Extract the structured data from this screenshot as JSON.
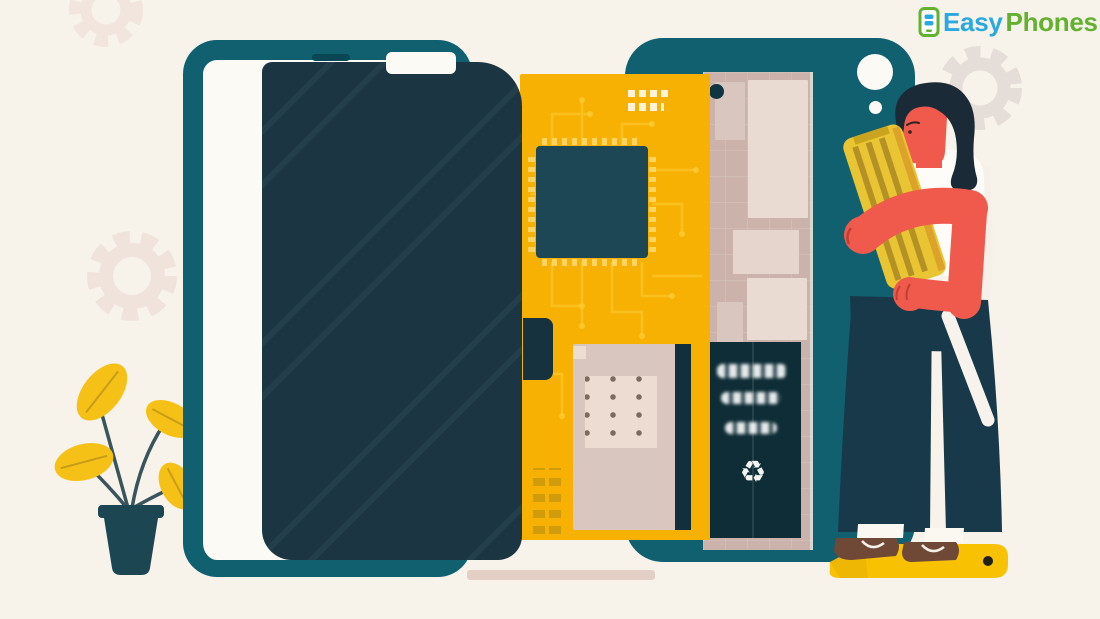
{
  "logo": {
    "easy": "Easy",
    "phones": "Phones"
  },
  "icons": {
    "recycle": "♻",
    "logo_phone": "phone-with-coins-icon"
  },
  "scene": {
    "subject": "smartphone-repair-illustration",
    "elements": [
      "phone-frame",
      "phone-screen-panel",
      "circuit-board",
      "chip",
      "phone-back-panel",
      "internal-battery",
      "camera-hole",
      "technician-woman",
      "replacement-battery",
      "screwdriver",
      "repair-mat",
      "potted-plant",
      "background-gears"
    ]
  },
  "colors": {
    "bg": "#f7f2ea",
    "interiorWhite": "#fcfaf4",
    "teal": "#106070",
    "slab": "#1b3642",
    "slabStreak": "#233f4c",
    "slit": "#0a4754",
    "connector": "#15323e",
    "pcb": "#f6b102",
    "chip": "#1d4754",
    "trace": "#ffce3a",
    "stamp": "#c9990b",
    "beige": "#cbb3ab",
    "beigeLight": "#e9dad2",
    "beigeMid": "#d9c6be",
    "panel": "#ecdcd2",
    "dotColor": "#7c6a63",
    "stripeDark": "#12303b",
    "batteryDark": "#0e2d37",
    "textWhite": "#f2f4f0",
    "screw": "#0d3542",
    "lip": "#e3cfc6",
    "coral": "#ef5a4d",
    "coralDark": "#c13f30",
    "hair": "#1a2b37",
    "pants": "#17394a",
    "shirt": "#fdfcf8",
    "cloth": "#f6f1e8",
    "battYellow": "#e9c533",
    "battStripe": "#ad8b22",
    "battEdge": "#dba32a",
    "battCap": "#caa31f",
    "mat": "#f8c202",
    "matShade": "#e2ab04",
    "matDot": "#201e16",
    "shoe": "#6f4936",
    "hem": "#fbf8f2",
    "driver": "#f7f3ec",
    "gearPink": "#f0e3dc",
    "gearGrey": "#e5ddd7",
    "pot": "#1b4652",
    "leaf": "#f6c116",
    "stem": "#3a545e",
    "vein": "#a8851a",
    "logoBlue": "#29a9e1",
    "logoGreen": "#62b22f"
  }
}
